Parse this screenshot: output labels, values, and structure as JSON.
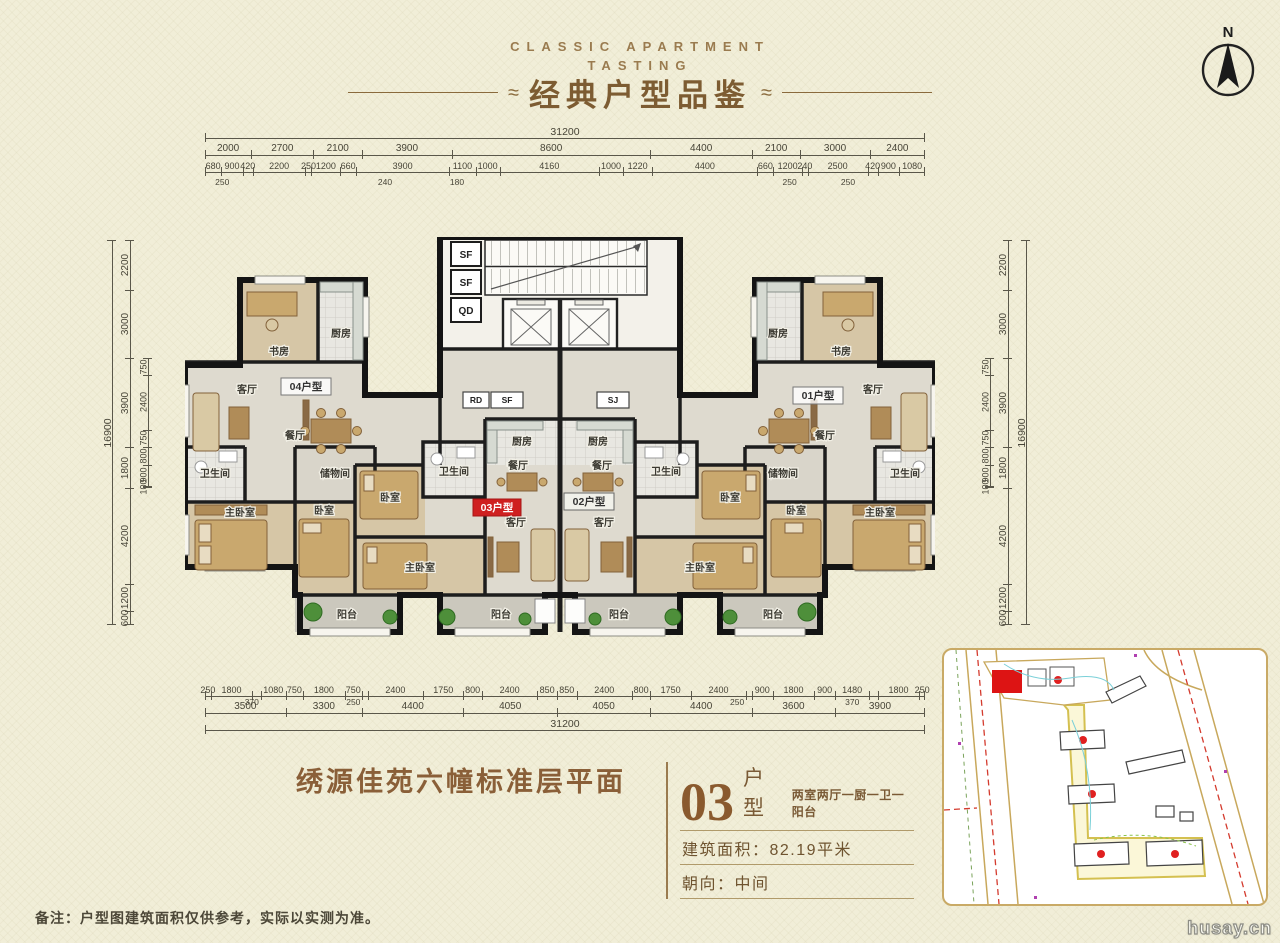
{
  "header": {
    "eyebrow_line1": "CLASSIC APARTMENT",
    "eyebrow_line2": "TASTING",
    "title": "经典户型品鉴",
    "ornament": "≈",
    "compass": "N"
  },
  "dims": {
    "top": {
      "total": [
        "31200"
      ],
      "row2": [
        "2000",
        "2700",
        "2100",
        "3900",
        "8600",
        "4400",
        "2100",
        "3000",
        "2400"
      ],
      "row3": [
        "680",
        "900",
        "420",
        "2200",
        "250",
        "1200",
        "660",
        "3900",
        "1100",
        "1000",
        "4160",
        "1000",
        "1220",
        "4400",
        "660",
        "1200",
        "240",
        "2500",
        "420",
        "900",
        "1080"
      ],
      "offsets": [
        "250",
        "240",
        "180",
        "250",
        "250"
      ]
    },
    "bottom": {
      "row1": [
        "250",
        "1800",
        "~370",
        "1080",
        "750",
        "1800",
        "750",
        "~250",
        "2400",
        "1750",
        "800",
        "2400",
        "850",
        "850",
        "2400",
        "800",
        "1750",
        "2400",
        "~250",
        "900",
        "1800",
        "900",
        "1480",
        "~370",
        "1800",
        "250"
      ],
      "row2": [
        "3500",
        "3300",
        "4400",
        "4050",
        "4050",
        "4400",
        "3600",
        "3900"
      ],
      "total": [
        "31200"
      ],
      "offsets": [
        "370",
        "250",
        "250",
        "370"
      ]
    },
    "left": {
      "total": [
        "16900"
      ],
      "main": [
        "2200",
        "3000",
        "3900",
        "1800",
        "4200",
        "1200",
        "600"
      ],
      "inner": [
        "750",
        "2400",
        "750",
        "800",
        "900",
        "100"
      ]
    },
    "right": {
      "total": [
        "16900"
      ],
      "main": [
        "2200",
        "3000",
        "3900",
        "1800",
        "4200",
        "1200",
        "600"
      ],
      "inner": [
        "750",
        "2400",
        "750",
        "800",
        "900",
        "100"
      ]
    }
  },
  "plan": {
    "rooms": {
      "study": "书房",
      "kitchen": "厨房",
      "living": "客厅",
      "dining": "餐厅",
      "bath": "卫生间",
      "storage": "储物间",
      "master": "主卧室",
      "bedroom": "卧室",
      "balcony": "阳台"
    },
    "units": {
      "u04": "04户型",
      "u03": "03户型",
      "u02": "02户型",
      "u01": "01户型"
    },
    "core": {
      "sf": "SF",
      "qd": "QD",
      "rd": "RD",
      "sj": "SJ"
    }
  },
  "title_block": {
    "project_title": "绣源佳苑六幢标准层平面"
  },
  "info": {
    "unit_number": "03",
    "unit_word": "户型",
    "unit_desc": "两室两厅一厨一卫一阳台",
    "area_line": "建筑面积：82.19平米",
    "orientation_line": "朝向：中间"
  },
  "footer": {
    "note": "备注：户型图建筑面积仅供参考，实际以实测为准。"
  },
  "watermark": "husay.cn"
}
